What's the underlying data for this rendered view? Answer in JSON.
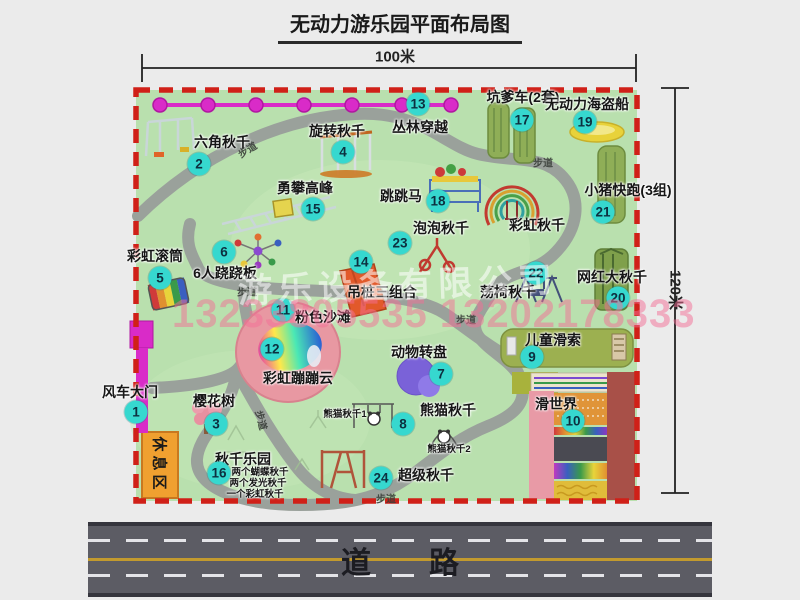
{
  "title": "无动力游乐园平面布局图",
  "dimensions": {
    "top": "100米",
    "right": "120米"
  },
  "road": {
    "label": "道路"
  },
  "watermarks": {
    "company": "游乐设备有限公司",
    "phone": "13233805535 13202178333"
  },
  "rest_area": {
    "label": "休息区"
  },
  "colors": {
    "park_green": "#b9e0ae",
    "border_red": "#d02018",
    "badge_teal": "#36d8cf",
    "gate_magenta": "#d92bc8",
    "road_gray": "#5c5c64",
    "beach_pink": "#e898a2"
  },
  "features": [
    {
      "num": "1",
      "label": "风车大门",
      "lx": 130,
      "ly": 392,
      "bx": 136,
      "by": 412
    },
    {
      "num": "2",
      "label": "六角秋千",
      "lx": 222,
      "ly": 142,
      "bx": 199,
      "by": 164
    },
    {
      "num": "3",
      "label": "樱花树",
      "lx": 214,
      "ly": 401,
      "bx": 216,
      "by": 424
    },
    {
      "num": "4",
      "label": "旋转秋千",
      "lx": 337,
      "ly": 131,
      "bx": 343,
      "by": 152
    },
    {
      "num": "5",
      "label": "彩虹滚筒",
      "lx": 155,
      "ly": 256,
      "bx": 160,
      "by": 278
    },
    {
      "num": "6",
      "label": "6人跷跷板",
      "lx": 225,
      "ly": 273,
      "bx": 224,
      "by": 252
    },
    {
      "num": "7",
      "label": "动物转盘",
      "lx": 419,
      "ly": 352,
      "bx": 441,
      "by": 374
    },
    {
      "num": "8",
      "label": "熊猫秋千",
      "lx": 448,
      "ly": 410,
      "bx": 403,
      "by": 424
    },
    {
      "num": "9",
      "label": "儿童滑索",
      "lx": 553,
      "ly": 340,
      "bx": 532,
      "by": 357
    },
    {
      "num": "10",
      "label": "滑世界",
      "lx": 556,
      "ly": 404,
      "bx": 573,
      "by": 421
    },
    {
      "num": "11",
      "label": "粉色沙滩",
      "lx": 323,
      "ly": 317,
      "bx": 283,
      "by": 310
    },
    {
      "num": "12",
      "label": "彩虹蹦蹦云",
      "lx": 298,
      "ly": 378,
      "bx": 272,
      "by": 349
    },
    {
      "num": "13",
      "label": "丛林穿越",
      "lx": 420,
      "ly": 127,
      "bx": 418,
      "by": 104
    },
    {
      "num": "14",
      "label": "吊桩三组合",
      "lx": 382,
      "ly": 292,
      "bx": 361,
      "by": 262
    },
    {
      "num": "15",
      "label": "勇攀高峰",
      "lx": 305,
      "ly": 188,
      "bx": 313,
      "by": 209
    },
    {
      "num": "16",
      "label": "秋千乐园",
      "lx": 243,
      "ly": 459,
      "bx": 219,
      "by": 473
    },
    {
      "num": "17",
      "label": "坑爹车(2套)",
      "lx": 523,
      "ly": 97,
      "bx": 522,
      "by": 120
    },
    {
      "num": "18",
      "label": "跳跳马",
      "lx": 401,
      "ly": 196,
      "bx": 438,
      "by": 201
    },
    {
      "num": "19",
      "label": "无动力海盗船",
      "lx": 587,
      "ly": 104,
      "bx": 585,
      "by": 122
    },
    {
      "num": "20",
      "label": "网红大秋千",
      "lx": 612,
      "ly": 277,
      "bx": 618,
      "by": 298
    },
    {
      "num": "21",
      "label": "小猪快跑(3组)",
      "lx": 628,
      "ly": 190,
      "bx": 603,
      "by": 212
    },
    {
      "num": "22",
      "label": "荡椅秋千",
      "lx": 508,
      "ly": 292,
      "bx": 536,
      "by": 273
    },
    {
      "num": "23",
      "label": "泡泡秋千",
      "lx": 441,
      "ly": 228,
      "bx": 400,
      "by": 243
    },
    {
      "num": "24",
      "label": "超级秋千",
      "lx": 426,
      "ly": 475,
      "bx": 381,
      "by": 478
    }
  ],
  "sub_labels": [
    {
      "text": "彩虹秋千",
      "x": 537,
      "y": 225,
      "small": false
    },
    {
      "text": "熊猫秋千1",
      "x": 345,
      "y": 413,
      "small": true
    },
    {
      "text": "熊猫秋千2",
      "x": 449,
      "y": 448,
      "small": true
    },
    {
      "text": "两个蝴蝶秋千",
      "x": 260,
      "y": 471,
      "small": true
    },
    {
      "text": "两个发光秋千",
      "x": 258,
      "y": 482,
      "small": true
    },
    {
      "text": "一个彩虹秋千",
      "x": 255,
      "y": 493,
      "small": true
    }
  ],
  "path_labels": [
    {
      "text": "步道",
      "x": 247,
      "y": 149,
      "rot": -32
    },
    {
      "text": "步道",
      "x": 543,
      "y": 162,
      "rot": 0
    },
    {
      "text": "步道",
      "x": 247,
      "y": 291,
      "rot": 0
    },
    {
      "text": "步道",
      "x": 466,
      "y": 319,
      "rot": 0
    },
    {
      "text": "步道",
      "x": 386,
      "y": 498,
      "rot": 0
    },
    {
      "text": "步道",
      "x": 262,
      "y": 420,
      "rot": 75
    }
  ]
}
